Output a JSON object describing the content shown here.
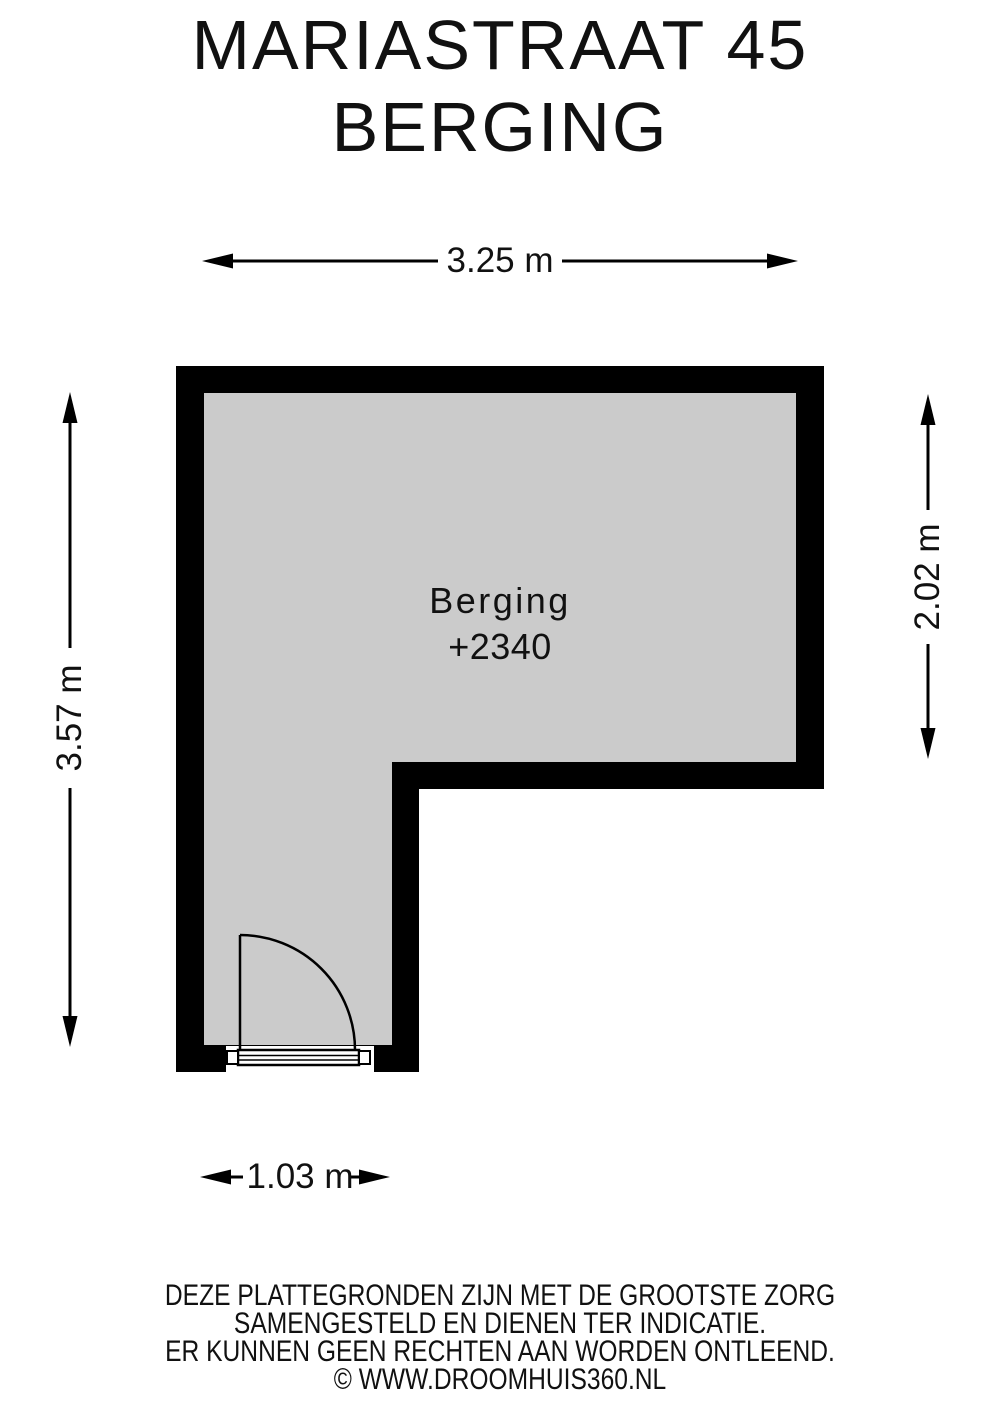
{
  "title": {
    "line1": "MARIASTRAAT 45",
    "line2": "BERGING"
  },
  "room": {
    "name": "Berging",
    "level": "+2340",
    "floor_fill": "#cbcbcb",
    "wall_color": "#000000"
  },
  "dimensions": {
    "top": "3.25 m",
    "left": "3.57 m",
    "right": "2.02 m",
    "bottom": "1.03 m"
  },
  "footer": {
    "line1": "DEZE PLATTEGRONDEN ZIJN MET DE GROOTSTE ZORG",
    "line2": "SAMENGESTELD EN DIENEN TER INDICATIE.",
    "line3": "ER KUNNEN GEEN RECHTEN AAN WORDEN ONTLEEND.",
    "line4": "© WWW.DROOMHUIS360.NL"
  }
}
